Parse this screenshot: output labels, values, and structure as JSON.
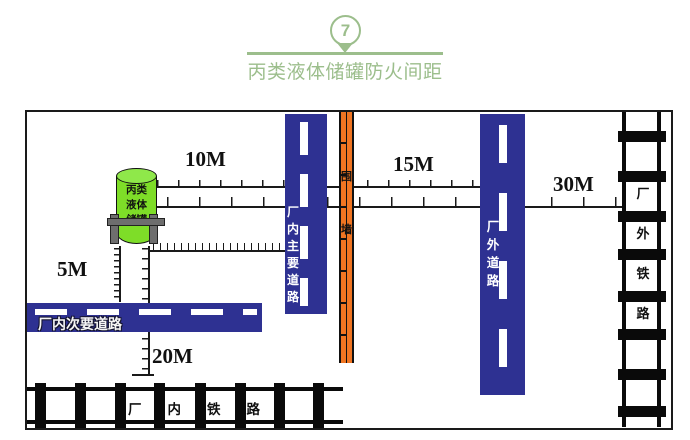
{
  "header": {
    "badge_number": "7",
    "title": "丙类液体储罐防火间距"
  },
  "colors": {
    "accent_green": "#9CBE8C",
    "tank_green": "#7EDD28",
    "road_blue": "#2E3192",
    "wall_orange": "#F07522"
  },
  "tank": {
    "label": "丙类液体储罐",
    "line1": "丙类",
    "line2": "液体",
    "line3": "储罐"
  },
  "distances": {
    "tank_to_main_road": "10M",
    "wall_to_outer_road": "15M",
    "outer_road_to_outer_railway": "30M",
    "tank_to_secondary_road": "5M",
    "tank_to_inner_railway": "20M"
  },
  "features": {
    "secondary_road": "厂内次要道路",
    "main_road": "厂内主要道路",
    "wall": "围墙",
    "outer_road": "厂外道路",
    "outer_railway": "厂外铁路",
    "inner_railway": "厂内铁路"
  }
}
